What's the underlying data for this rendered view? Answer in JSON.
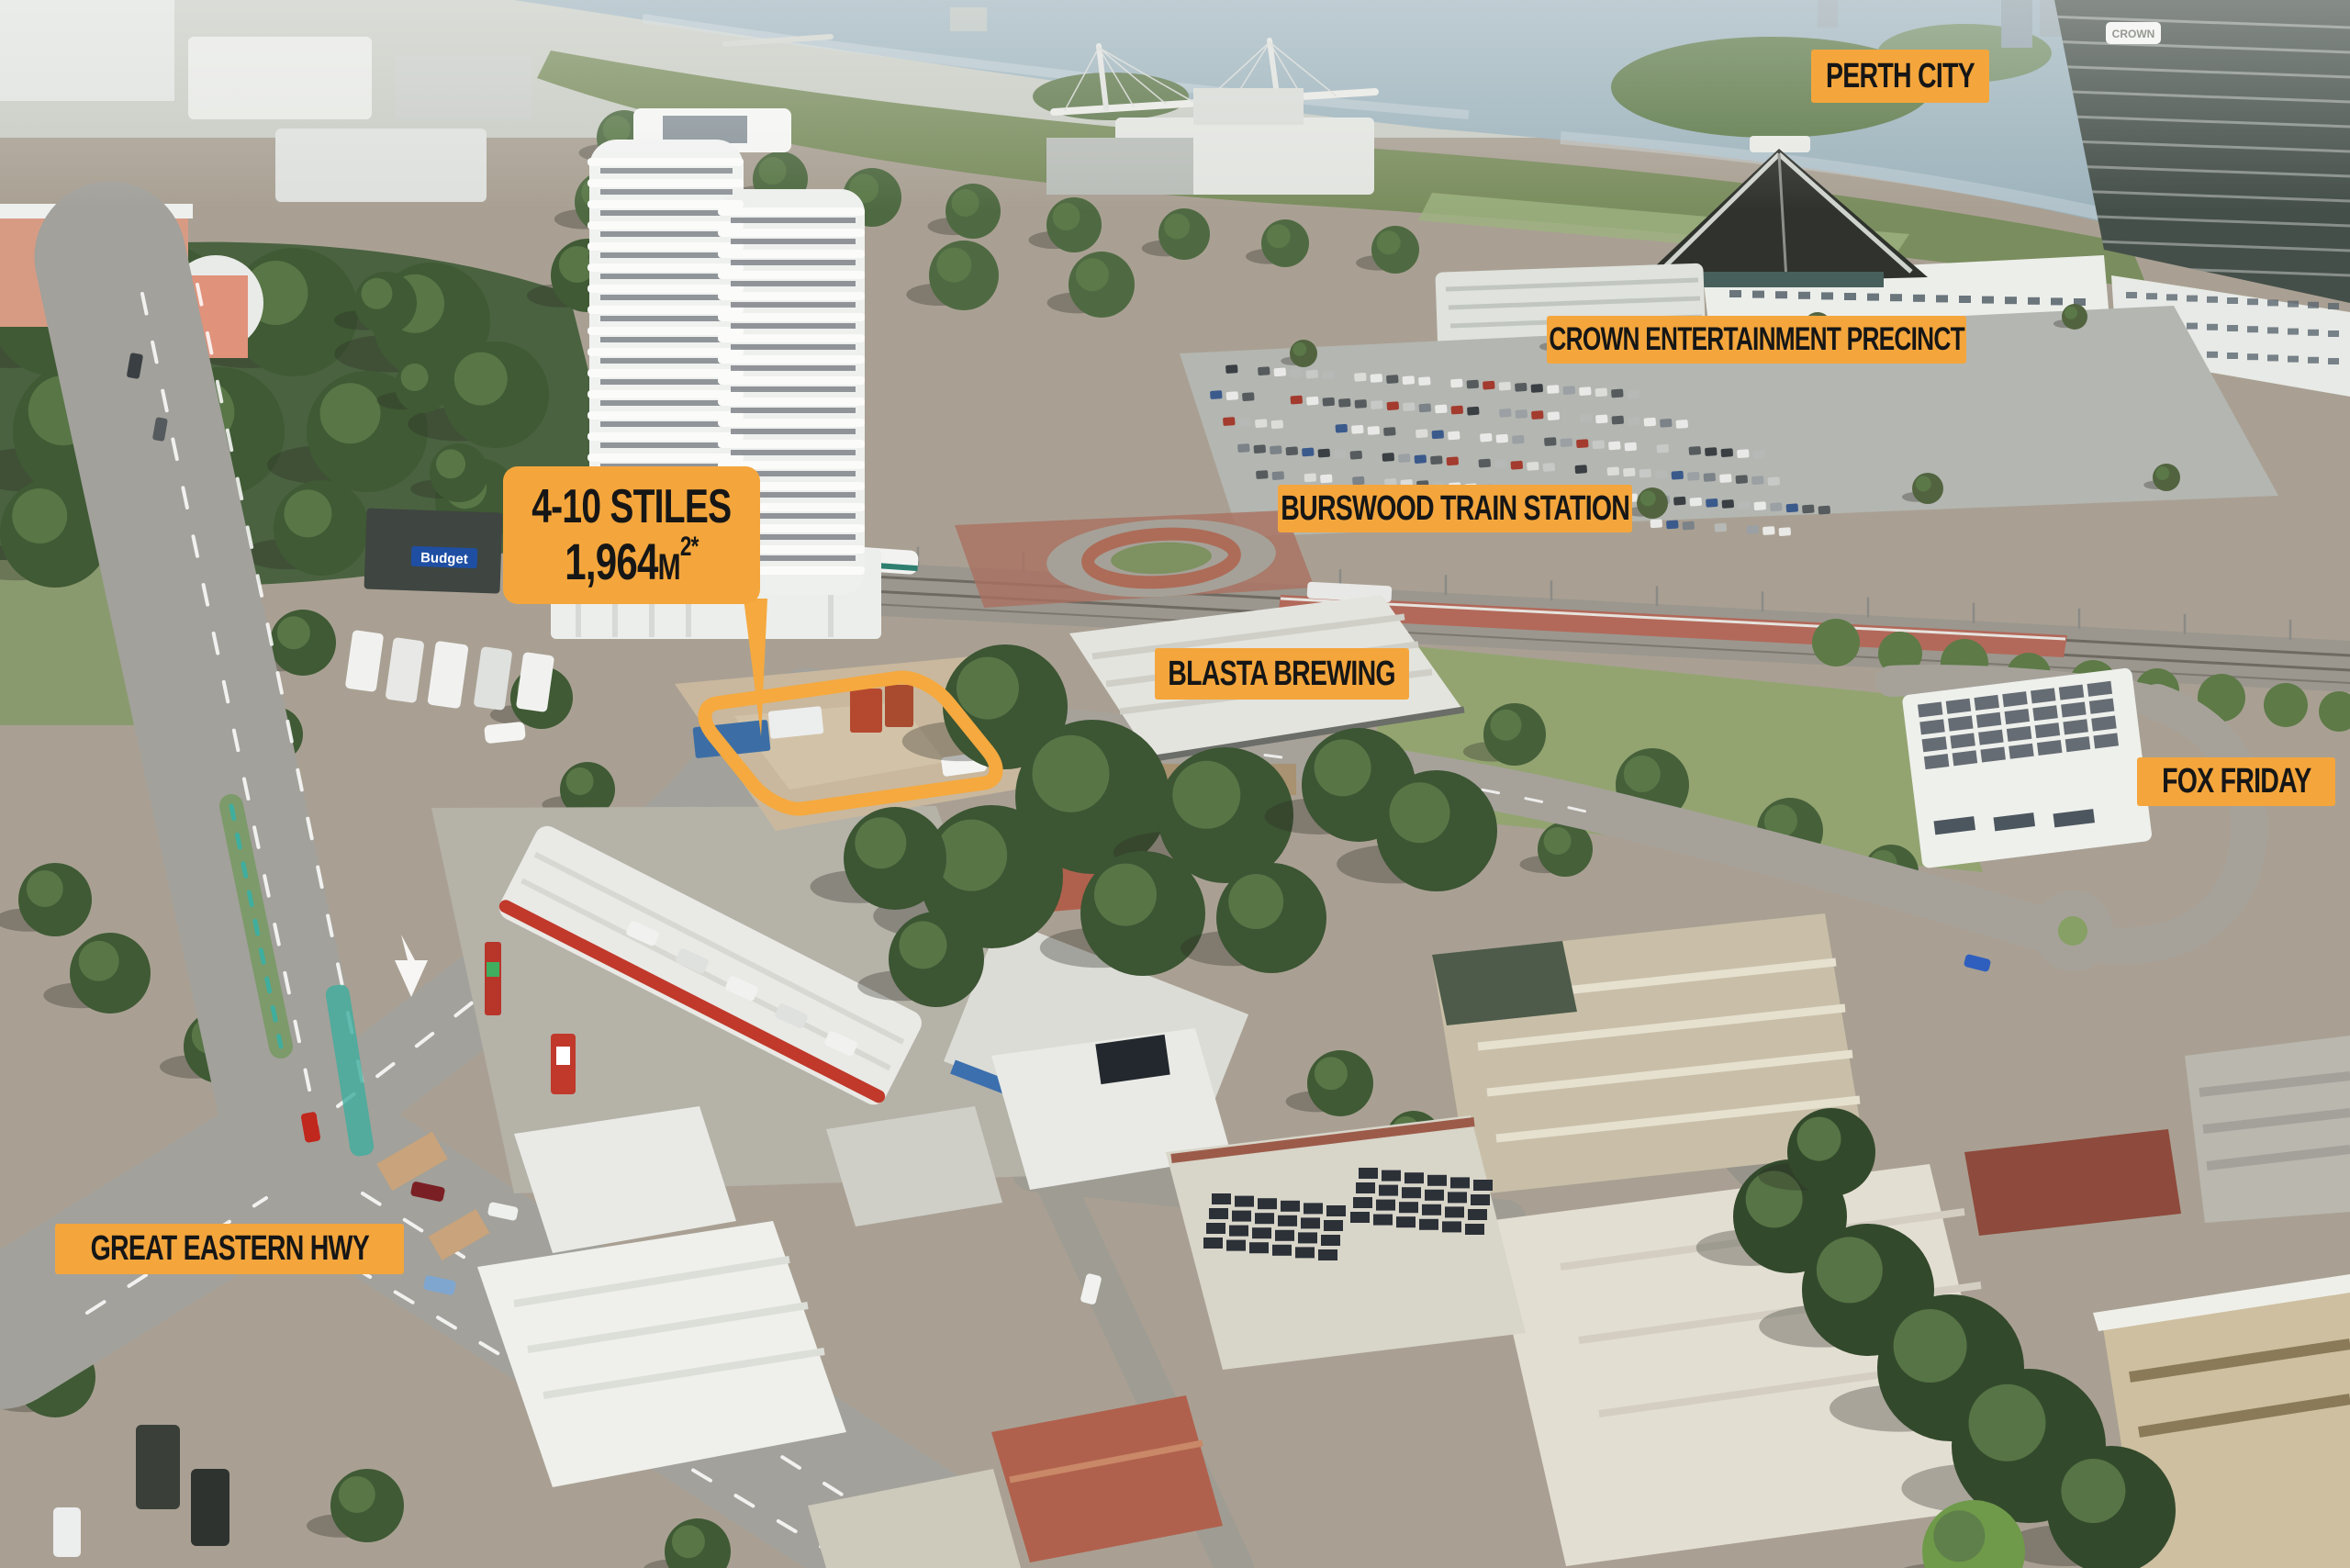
{
  "annotations": {
    "perth_city": "PERTH CITY",
    "crown_precinct": "CROWN ENTERTAINMENT PRECINCT",
    "burswood_station": "BURSWOOD TRAIN STATION",
    "blasta_brewing": "BLASTA BREWING",
    "fox_friday": "FOX FRIDAY",
    "great_eastern_hwy": "GREAT EASTERN HWY"
  },
  "property": {
    "address": "4-10 STILES",
    "area": "1,964",
    "area_unit": "M",
    "area_superscript": "2*"
  },
  "signs": {
    "crown_tower_sign": "CROWN",
    "budget_sign": "Budget"
  },
  "colors": {
    "annotation_bg": "#F4A63C",
    "annotation_text": "#161616",
    "boundary": "#F5A93F"
  }
}
